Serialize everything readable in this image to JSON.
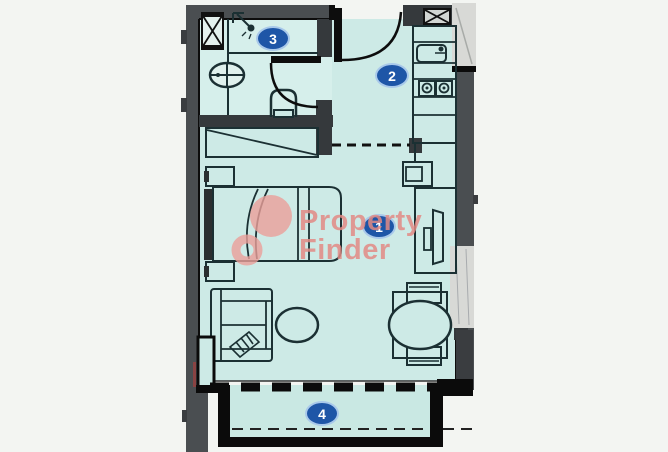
{
  "floorplan": {
    "markers": [
      {
        "number": "1"
      },
      {
        "number": "2"
      },
      {
        "number": "3"
      },
      {
        "number": "4"
      }
    ],
    "watermark": {
      "word1": "Property",
      "word2": "Finder"
    },
    "colors": {
      "background": "#f3f5f2",
      "floor": "#cdeae6",
      "bathroom_floor": "#d6efeb",
      "wall_gray": "#4a4e51",
      "wall_dark": "#35393c",
      "line_black": "#0d0d0d",
      "furniture_line": "#1b3033",
      "marker_fill": "#1e56a7",
      "marker_border": "#a9c9ea",
      "marker_text": "#ffffff",
      "watermark_pink": "#e28a84",
      "panel_gray": "#d8d9d6",
      "accent_red": "#8a4343"
    },
    "icons": [
      "shower-icon",
      "washbasin-icon",
      "toilet-icon",
      "shaft-x-icon",
      "vent-x-icon",
      "kitchen-sink-icon",
      "stove-icon",
      "entrance-door-arc-icon",
      "bathroom-door-arc-icon",
      "bed-icon",
      "wardrobe-icon",
      "sofa-icon",
      "coffee-table-icon",
      "tv-unit-icon",
      "dining-table-icon",
      "property-finder-logo-icon"
    ]
  }
}
